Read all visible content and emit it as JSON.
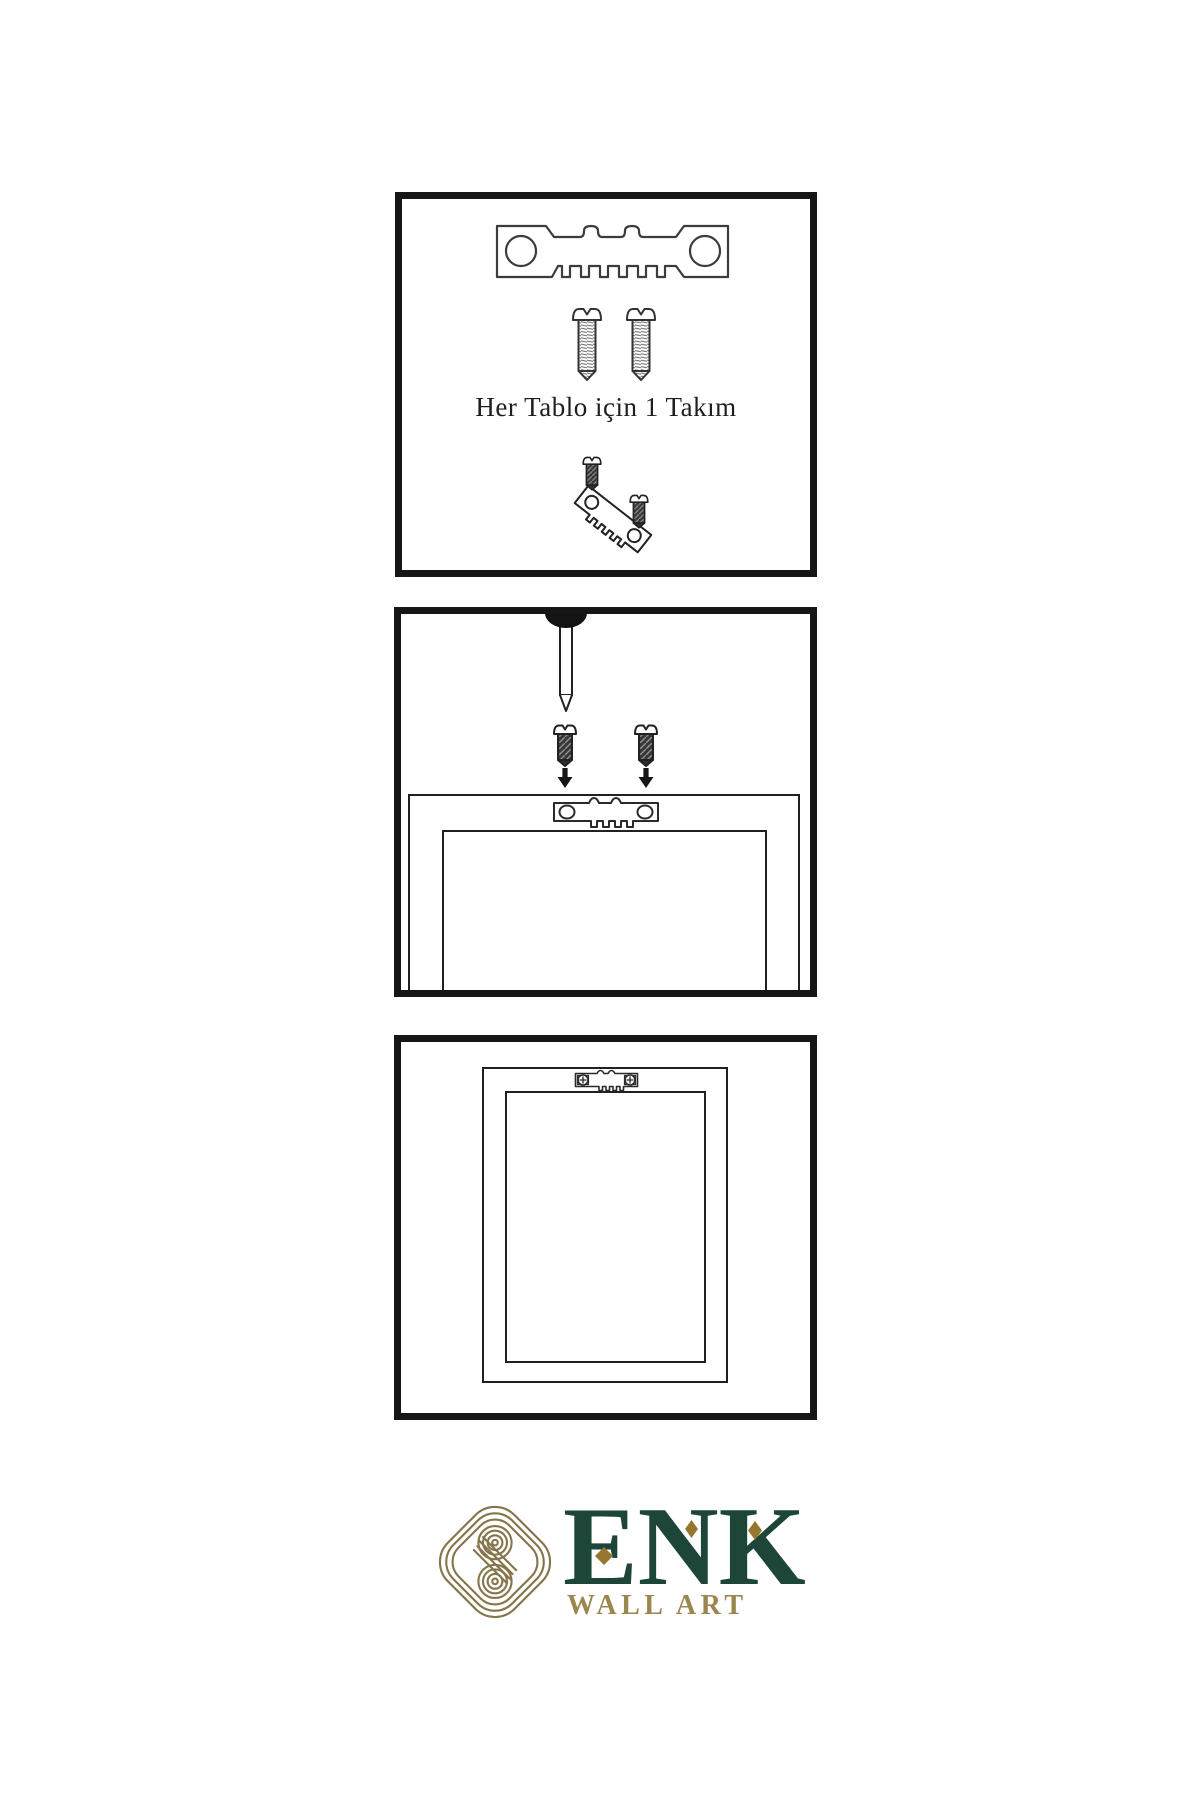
{
  "document": {
    "type": "picture-hanging-instructions",
    "language": "Turkish",
    "background_color": "#ffffff",
    "ink_color": "#1c1c1c"
  },
  "panels": [
    {
      "name": "hardware-kit",
      "caption": "Her Tablo için 1 Takım",
      "illustrations": [
        "sawtooth-hanger",
        "screw",
        "screw",
        "screw-into-tilted-hanger"
      ]
    },
    {
      "name": "mount-hanger-on-frame-back",
      "illustrations": [
        "wall-nail",
        "screw-with-down-arrow",
        "screw-with-down-arrow",
        "frame-back",
        "sawtooth-hanger"
      ]
    },
    {
      "name": "frame-with-installed-hanger",
      "illustrations": [
        "frame-back",
        "sawtooth-hanger-with-screws"
      ]
    }
  ],
  "logo": {
    "brand": "ENK",
    "subtitle": "WALL ART",
    "icon": "interlocking-knot",
    "colors": {
      "brand_green": "#1d4639",
      "diamond_gold": "#97762f",
      "subtitle_gold": "#9c8650",
      "icon_gold": "#85754a"
    }
  }
}
